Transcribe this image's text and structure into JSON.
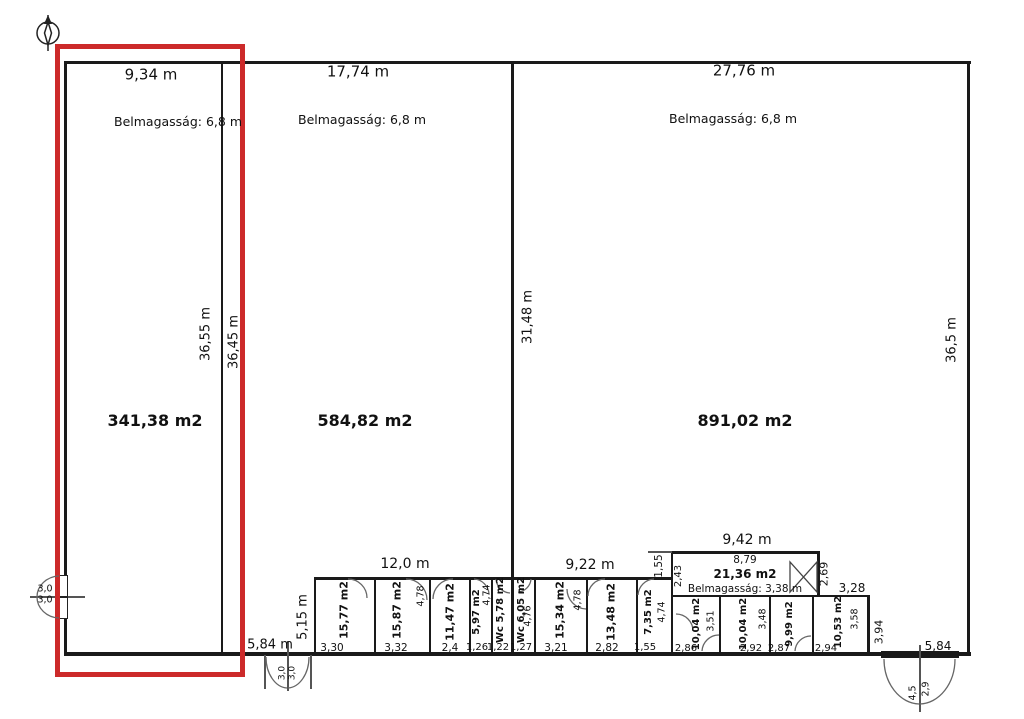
{
  "colors": {
    "hl": "#cc2a2a",
    "wall": "#1a1a1a",
    "line": "#555"
  },
  "sections": {
    "left": {
      "width": "9,34 m",
      "ceiling": "Belmagasság: 6,8 m",
      "area": "341,38 m2",
      "depth_outer": "36,55 m",
      "depth_inner": "36,45 m"
    },
    "middle": {
      "width": "17,74 m",
      "ceiling": "Belmagasság: 6,8 m",
      "area": "584,82 m2",
      "depth": "31,48 m"
    },
    "right": {
      "width": "27,76 m",
      "ceiling": "Belmagasság: 6,8 m",
      "area": "891,02 m2",
      "depth": "36,5 m"
    }
  },
  "dims": {
    "row_depth": "5,15 m",
    "group1": "12,0 m",
    "group2": "9,22 m",
    "mezz": "9,42 m",
    "door_left_width": "5,84 m",
    "door_right_width": "5,84",
    "gap_top": "3,28",
    "gap_depth": "3,94",
    "mezz_offset": "1,55",
    "mezz_left": "2,43",
    "mezz_right": "2,69",
    "west_door_leaf1": "3,0",
    "west_door_leaf2": "3,0",
    "door_left_leaf1": "3,0",
    "door_left_leaf2": "3,0",
    "door_right_leaf1": "4,5",
    "door_right_leaf2": "2,9"
  },
  "mezzanine": {
    "inner_width": "8,79",
    "area": "21,36 m2",
    "ceiling": "Belmagasság: 3,38 m"
  },
  "rooms": [
    {
      "area": "15,77 m2",
      "width": "3,30"
    },
    {
      "area": "15,87 m2",
      "width": "3,32",
      "depth": "4,78"
    },
    {
      "area": "11,47 m2",
      "width": "2,4"
    },
    {
      "area": "5,97 m2",
      "width": "1,26",
      "depth": "4,74"
    },
    {
      "area": "Wc 5,78 m2",
      "width": "1,22"
    },
    {
      "area": "Wc 6,05 m2",
      "width": "1,27",
      "depth": "4,76"
    },
    {
      "area": "15,34 m2",
      "width": "3,21",
      "depth": "4,78"
    },
    {
      "area": "13,48 m2",
      "width": "2,82"
    },
    {
      "area": "7,35 m2",
      "width": "1,55",
      "depth": "4,74"
    },
    {
      "area": "10,04 m2",
      "width": "2,86",
      "depth": "3,51"
    },
    {
      "area": "10,04 m2",
      "width": "2,92",
      "depth": "3,48"
    },
    {
      "area": "9,99 m2",
      "width": "2,87"
    },
    {
      "area": "10,53 m2",
      "width": "2,94",
      "depth": "3,58"
    }
  ]
}
